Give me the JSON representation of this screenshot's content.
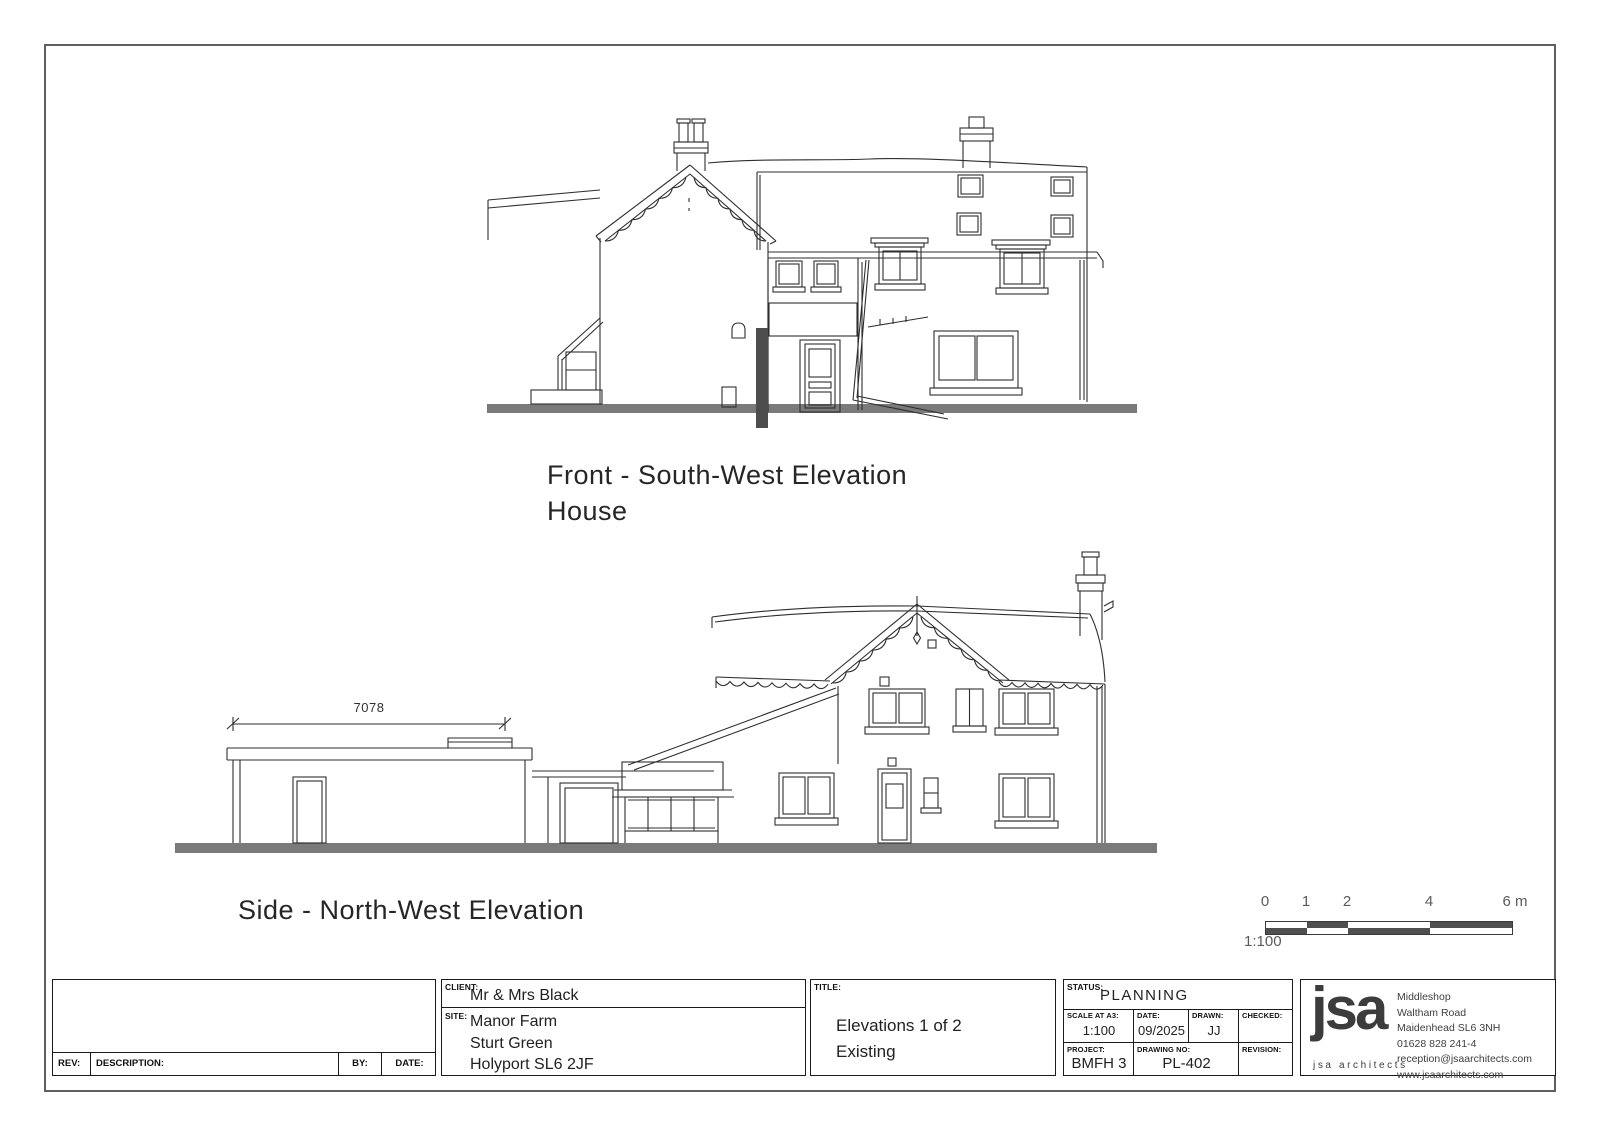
{
  "sheet": {
    "front_elevation": {
      "label_line1": "Front - South-West Elevation",
      "label_line2": "House"
    },
    "side_elevation": {
      "label": "Side - North-West Elevation",
      "dimension_mm": "7078"
    },
    "scale_bar": {
      "tick_0": "0",
      "tick_1": "1",
      "tick_2": "2",
      "tick_4": "4",
      "tick_6": "6 m",
      "ratio": "1:100"
    },
    "title_block": {
      "revision_table": {
        "rev_label": "REV:",
        "description_label": "DESCRIPTION:",
        "by_label": "BY:",
        "date_label": "DATE:"
      },
      "client": {
        "label": "CLIENT:",
        "value": "Mr & Mrs Black"
      },
      "site": {
        "label": "SITE:",
        "line1": "Manor Farm",
        "line2": "Sturt Green",
        "line3": "Holyport SL6 2JF"
      },
      "title": {
        "label": "TITLE:",
        "line1": "Elevations 1 of 2",
        "line2": "Existing"
      },
      "status": {
        "label": "STATUS:",
        "value": "PLANNING"
      },
      "scale": {
        "label": "SCALE AT A3:",
        "value": "1:100"
      },
      "date": {
        "label": "DATE:",
        "value": "09/2025"
      },
      "drawn": {
        "label": "DRAWN:",
        "value": "JJ"
      },
      "checked": {
        "label": "CHECKED:",
        "value": ""
      },
      "project": {
        "label": "PROJECT:",
        "value": "BMFH 3"
      },
      "drawing_no": {
        "label": "DRAWING NO:",
        "value": "PL-402"
      },
      "revision": {
        "label": "REVISION:",
        "value": ""
      },
      "firm": {
        "logo": "jsa",
        "tagline": "jsa architects",
        "address1": "Middleshop",
        "address2": "Waltham Road",
        "address3": "Maidenhead  SL6 3NH",
        "address4": "01628 828 241-4",
        "address5": "reception@jsaarchitects.com",
        "address6": "www.jsaarchitects.com"
      }
    },
    "colors": {
      "line": "#2e2e2e",
      "ground": "#7a7a7a",
      "accent_dark": "#4d4d4d"
    }
  }
}
